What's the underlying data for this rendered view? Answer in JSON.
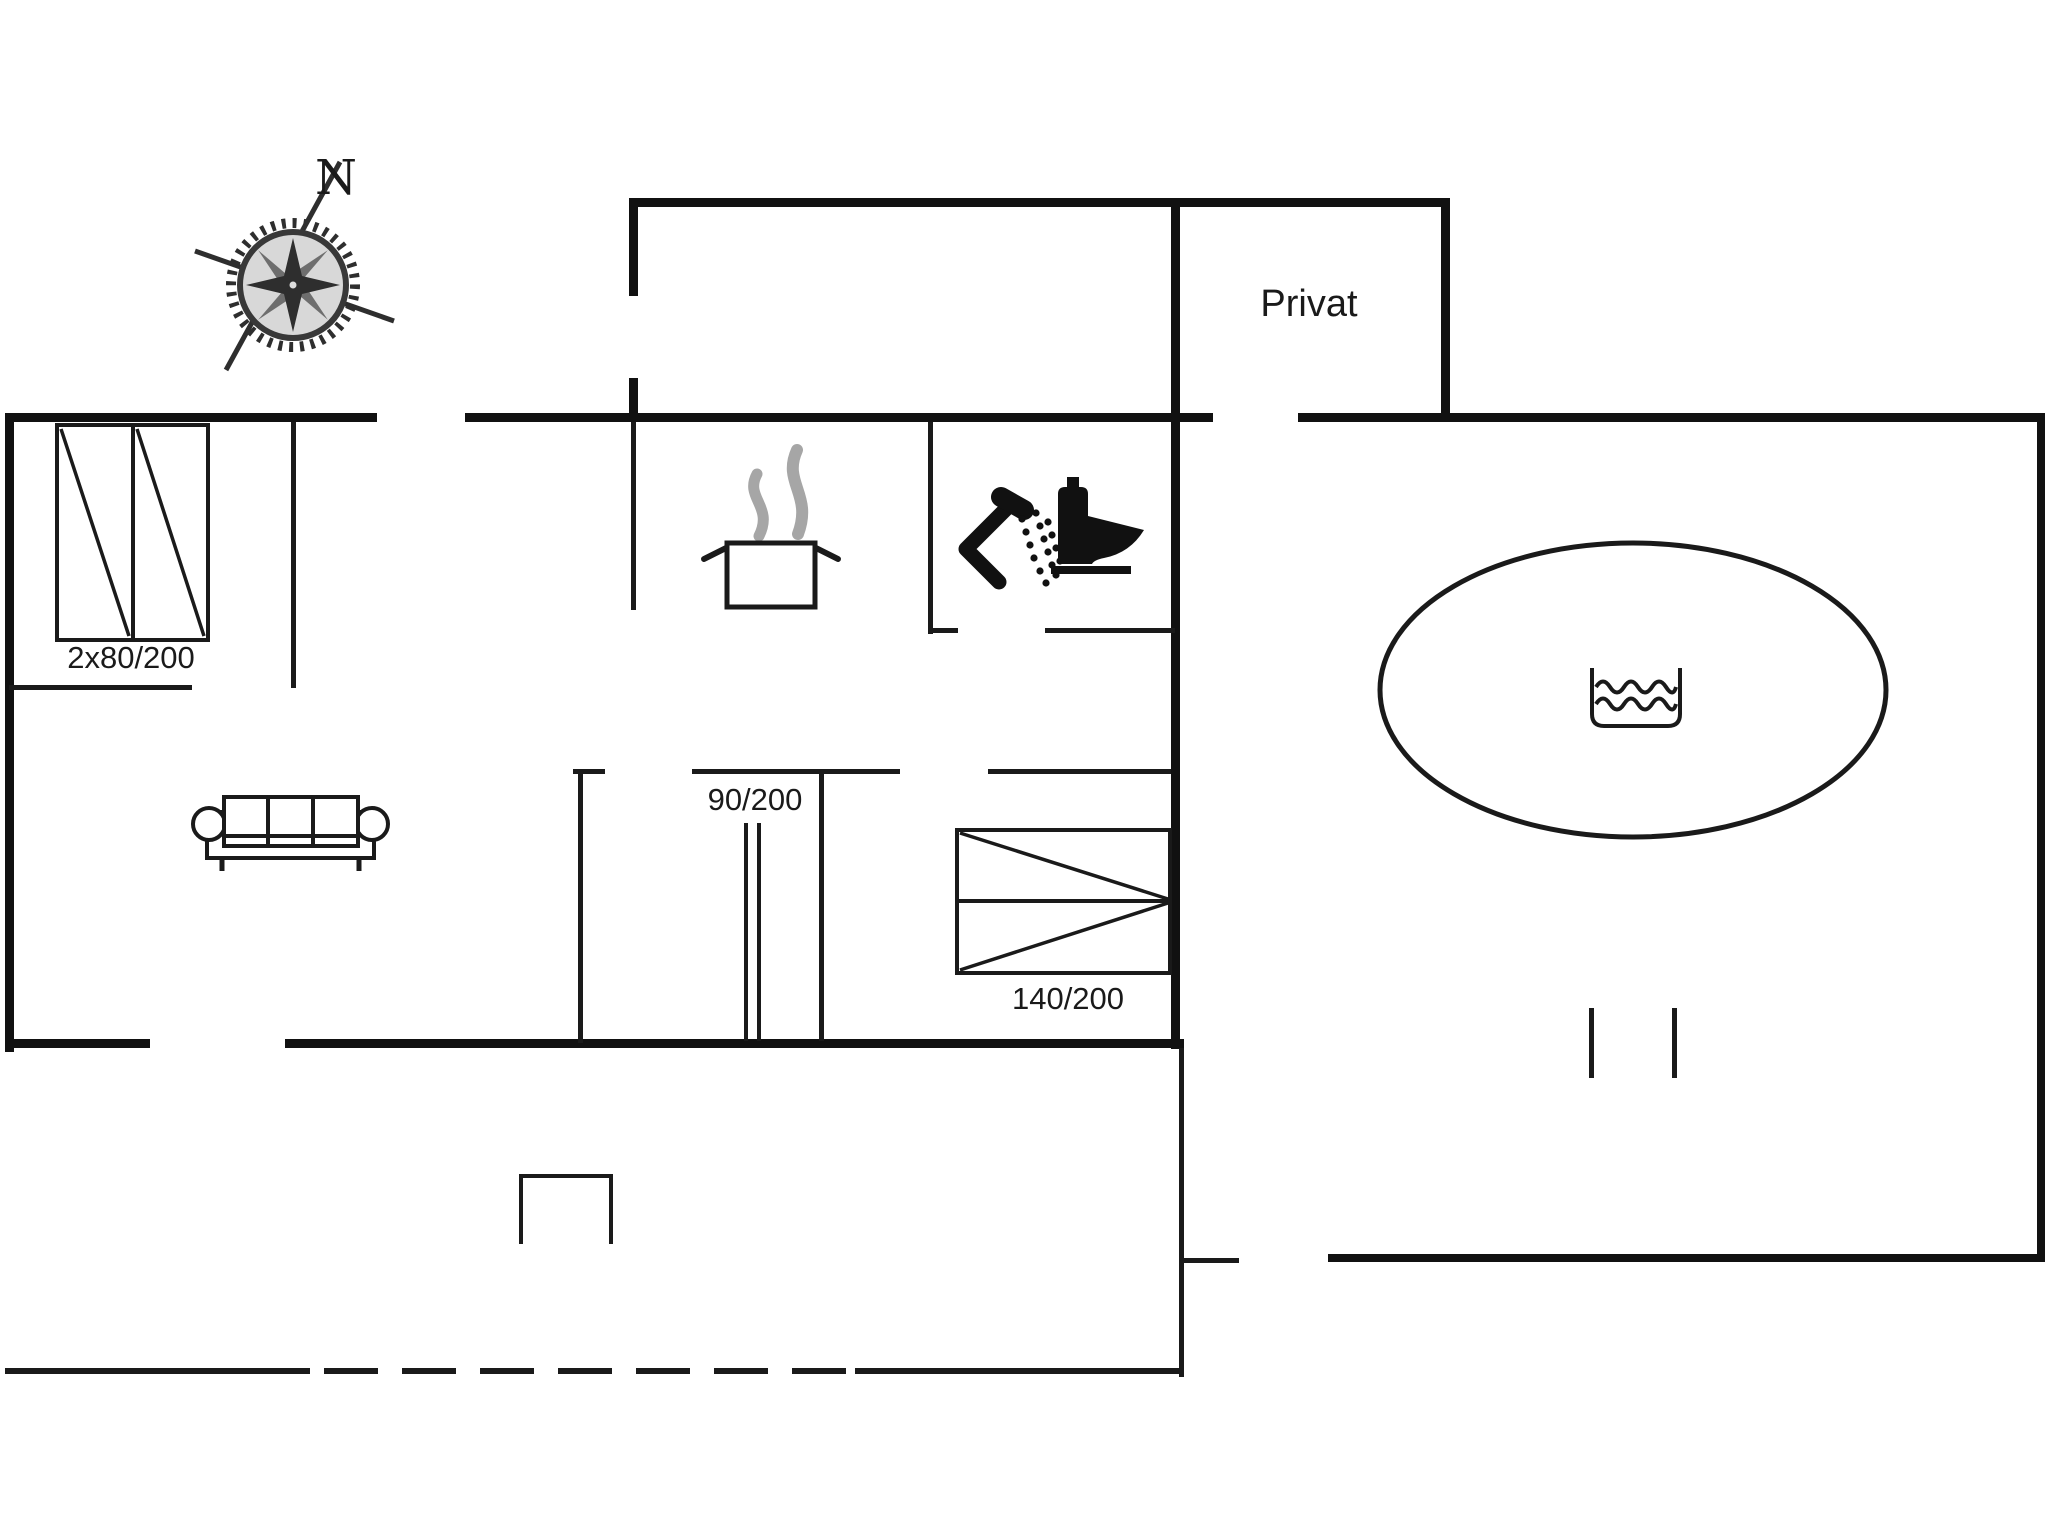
{
  "drawing": {
    "type": "floor-plan",
    "labels": {
      "north": "N",
      "privat": "Privat",
      "wardrobe_dimension": "2x80/200",
      "sliding_door_dimension": "90/200",
      "bed_dimension": "140/200"
    },
    "icons": {
      "compass": "compass-rose-icon",
      "stove": "cooking-pot-steam-icon",
      "shower": "shower-icon",
      "toilet": "toilet-icon",
      "sofa": "sofa-icon",
      "bed": "double-bed-icon",
      "wardrobe": "double-wardrobe-icon",
      "whirlpool": "water-basin-icon"
    },
    "colors": {
      "background": "#ffffff",
      "walls": "#111111",
      "steam": "#a6a6a6",
      "compass_gray": "#6e6e6e"
    }
  }
}
